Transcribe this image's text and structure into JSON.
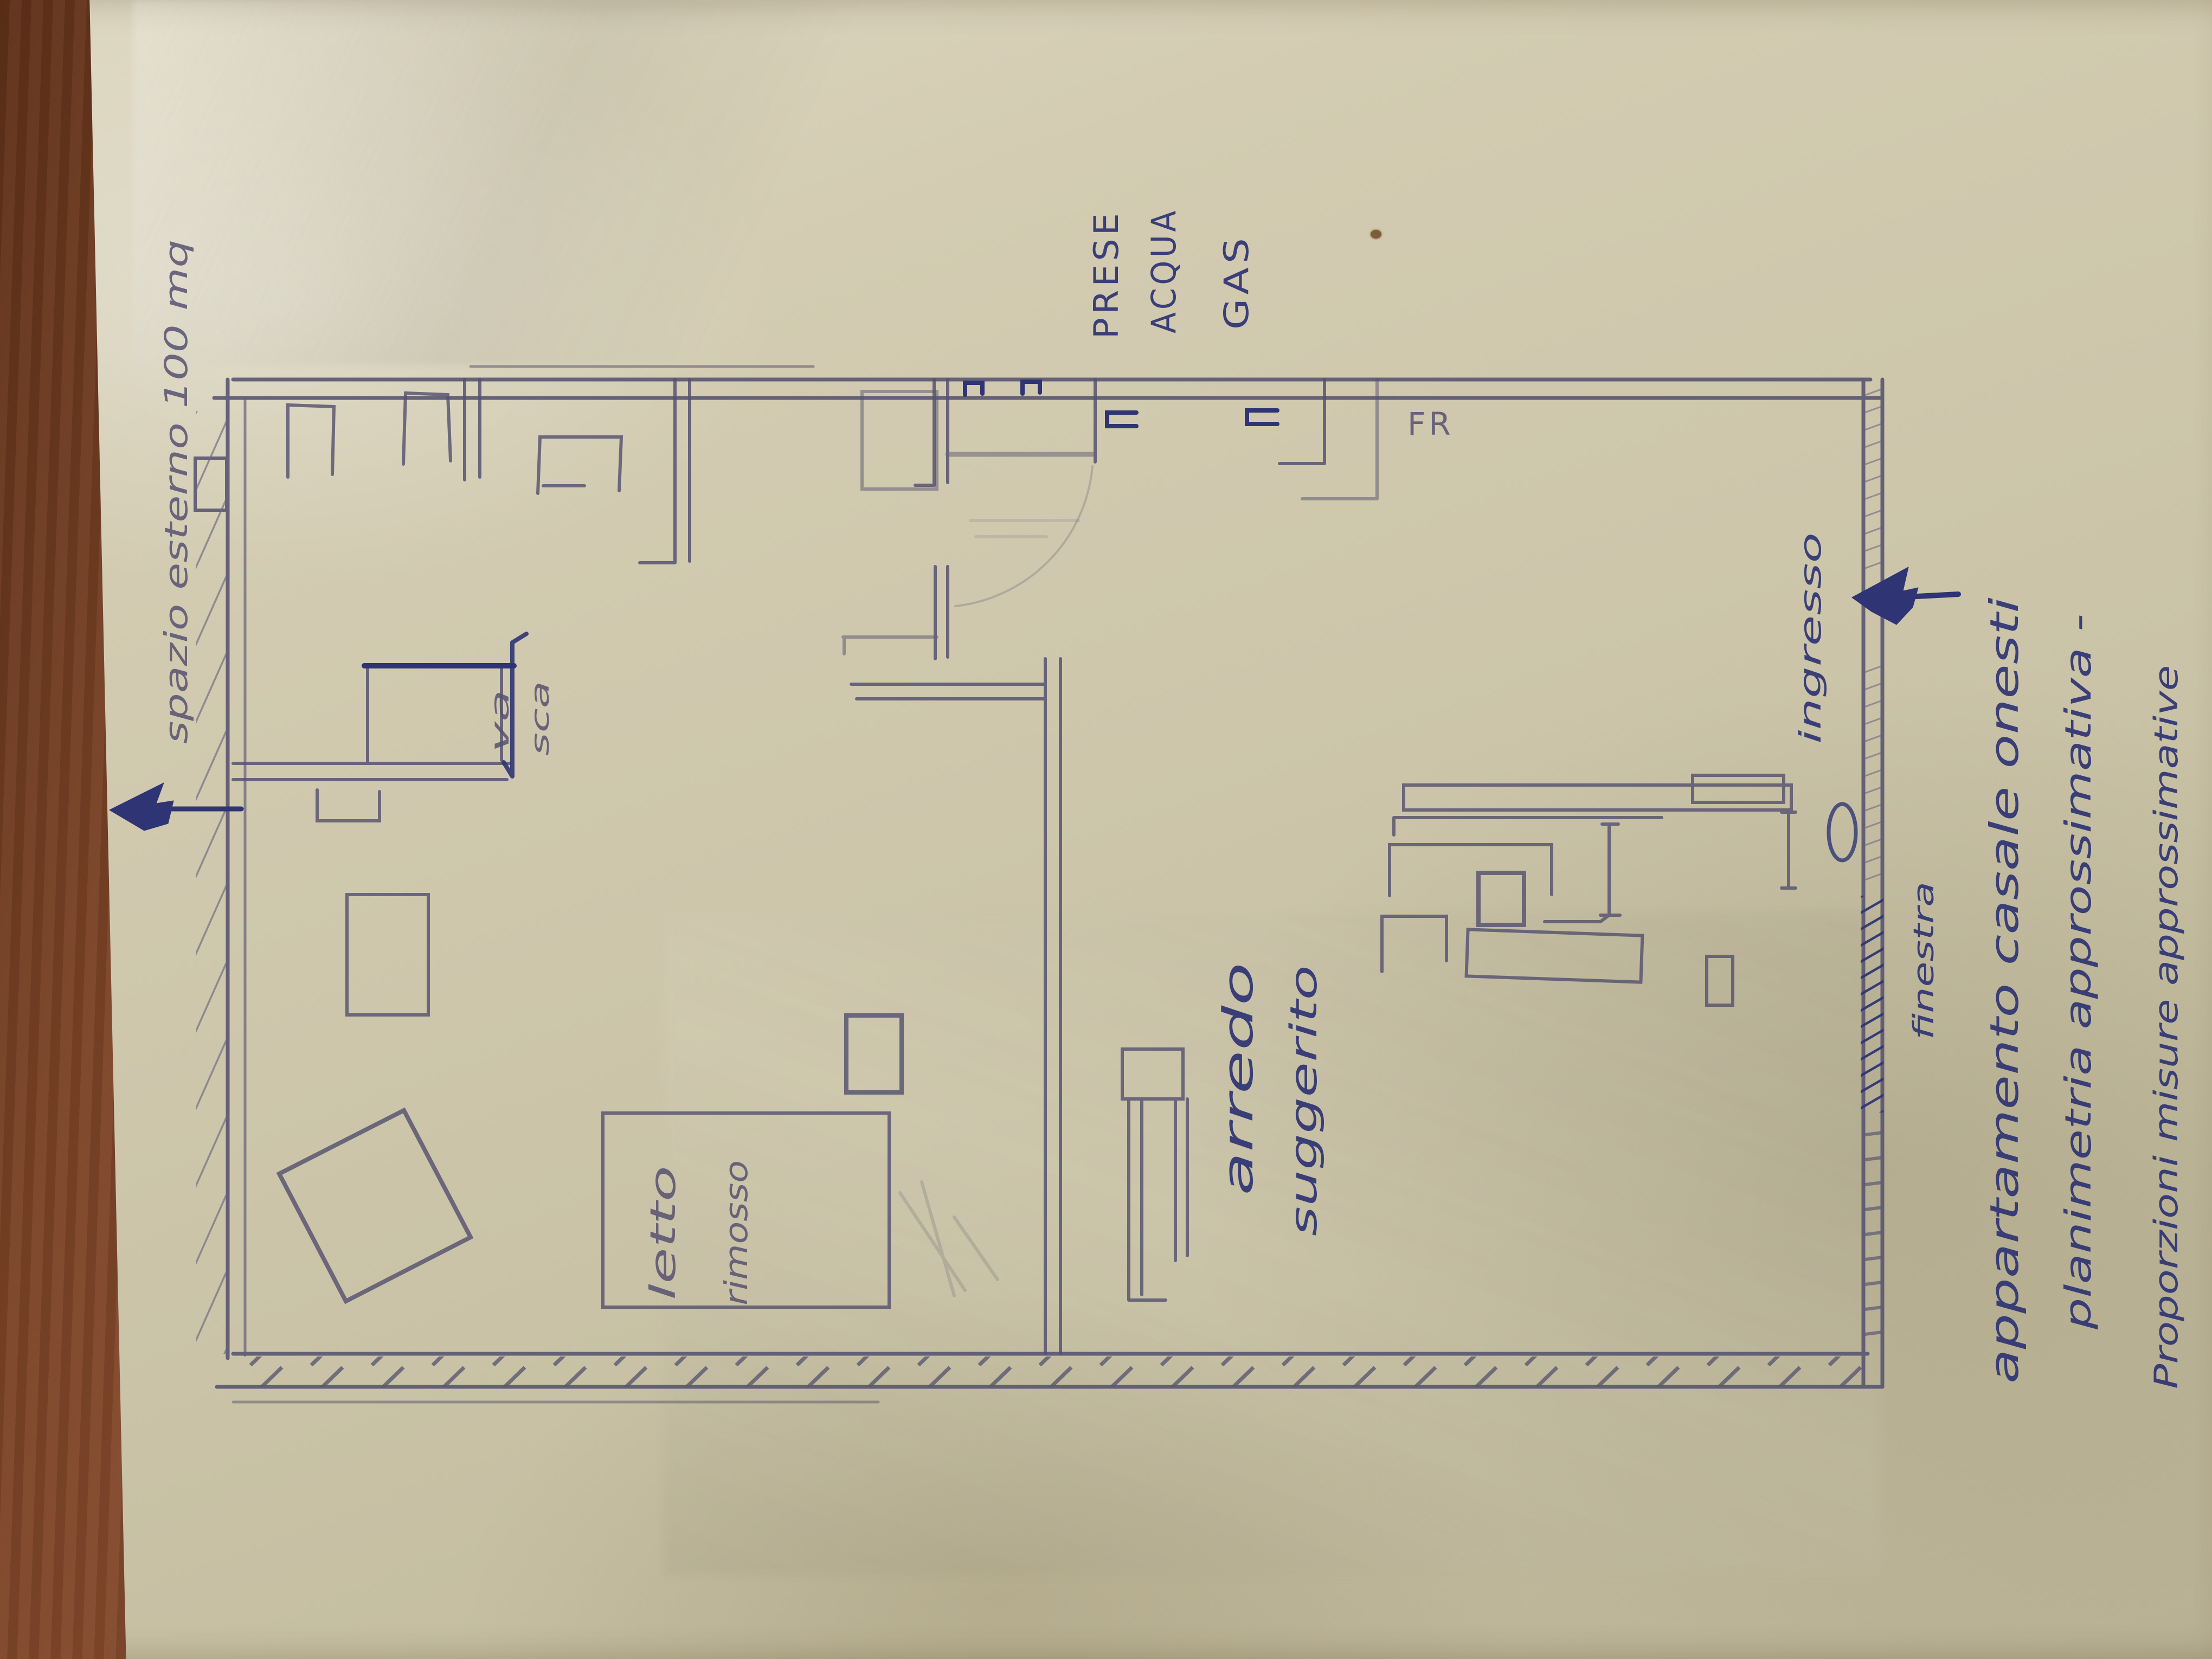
{
  "photo": {
    "description": "hand-drawn apartment floor plan sketch on yellowed paper, photographed on a wooden table, all annotations rotated 90 degrees",
    "colors": {
      "paper": "#cfc9ae",
      "wood": "#7a452a",
      "pencil": "#565270",
      "pen_ink": "#2e3474"
    }
  },
  "annotations": {
    "outdoor_space": "spazio esterno 100 mq",
    "utilities": {
      "line1": "PRESE",
      "line2": "ACQUA",
      "line3": "GAS"
    },
    "fridge": "FR",
    "bathtub": {
      "line1": "va",
      "line2": "sca"
    },
    "entrance": "ingresso",
    "bed_removed": {
      "line1": "letto",
      "line2": "rimosso"
    },
    "furniture_suggested": {
      "line1": "arredo",
      "line2": "suggerito"
    },
    "window": "finestra",
    "title_block": {
      "line1": "appartamento casale onesti",
      "line2": "planimetria approssimativa -",
      "line3": "Proporzioni misure approssimative"
    }
  }
}
